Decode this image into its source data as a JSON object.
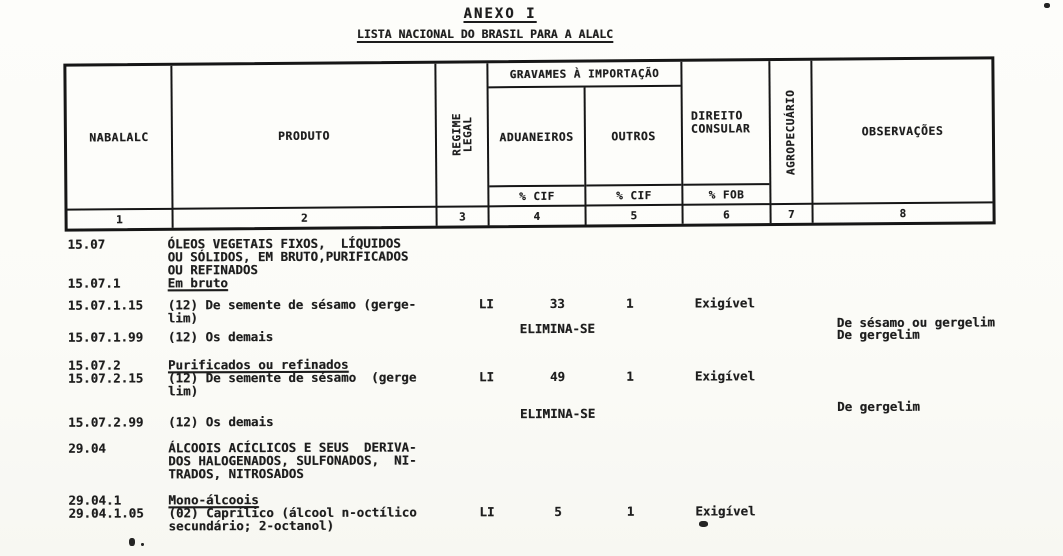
{
  "colors": {
    "ink": "#1d1d1d",
    "paper": "#fbfbf7",
    "border": "#161616"
  },
  "doc": {
    "title": "ANEXO I",
    "subtitle": "LISTA NACIONAL DO BRASIL PARA A ALALC"
  },
  "table": {
    "header": {
      "col1": {
        "label": "NABALALC",
        "num": "1"
      },
      "col2": {
        "label": "PRODUTO",
        "num": "2"
      },
      "col3": {
        "label_line1": "REGIME",
        "label_line2": "LEGAL",
        "num": "3"
      },
      "gravames": "GRAVAMES À IMPORTAÇÃO",
      "col4": {
        "label": "ADUANEIROS",
        "unit": "% CIF",
        "num": "4"
      },
      "col5": {
        "label": "OUTROS",
        "unit": "% CIF",
        "num": "5"
      },
      "col6": {
        "label_line1": "DIREITO",
        "label_line2": "CONSULAR",
        "unit": "% FOB",
        "num": "6"
      },
      "col7": {
        "label": "AGROPECUÁRIO",
        "num": "7"
      },
      "col8": {
        "label": "OBSERVAÇÕES",
        "num": "8"
      }
    },
    "rows": [
      {
        "code": "15.07",
        "produto": [
          "ÓLEOS VEGETAIS FIXOS,  LÍQUIDOS",
          "OU SÓLIDOS, EM BRUTO,PURIFICADOS",
          "OU REFINADOS"
        ]
      },
      {
        "code": "15.07.1",
        "produto": [
          "Em bruto"
        ]
      },
      {
        "code": "15.07.1.15",
        "produto": [
          "(12) De semente de sésamo (gerge-",
          "lim)"
        ],
        "regime": "LI",
        "aduaneiros": "33",
        "outros": "1",
        "consular": "Exigível",
        "obs": "De sésamo ou gergelim"
      },
      {
        "code": "15.07.1.99",
        "produto": [
          "(12) Os demais"
        ],
        "aduaneiros": "ELIMINA-SE",
        "obs": "De gergelim"
      },
      {
        "code": "15.07.2",
        "produto": [
          "Purificados ou refinados"
        ]
      },
      {
        "code": "15.07.2.15",
        "produto": [
          "(12) De semente de sésamo  (gerge",
          "lim)"
        ],
        "regime": "LI",
        "aduaneiros": "49",
        "outros": "1",
        "consular": "Exigível"
      },
      {
        "code": "15.07.2.99",
        "produto": [
          "(12) Os demais"
        ],
        "aduaneiros": "ELIMINA-SE",
        "obs": "De gergelim"
      },
      {
        "code": "29.04",
        "produto": [
          "ÁLCOOIS ACÍCLICOS E SEUS  DERIVA-",
          "DOS HALOGENADOS, SULFONADOS,  NI-",
          "TRADOS, NITROSADOS"
        ]
      },
      {
        "code": "29.04.1",
        "produto": [
          "Mono-álcoois"
        ]
      },
      {
        "code": "29.04.1.05",
        "produto": [
          "(02) Caprílico (álcool n-octílico",
          "secundário; 2-octanol)"
        ],
        "regime": "LI",
        "aduaneiros": "5",
        "outros": "1",
        "consular": "Exigível"
      }
    ]
  }
}
